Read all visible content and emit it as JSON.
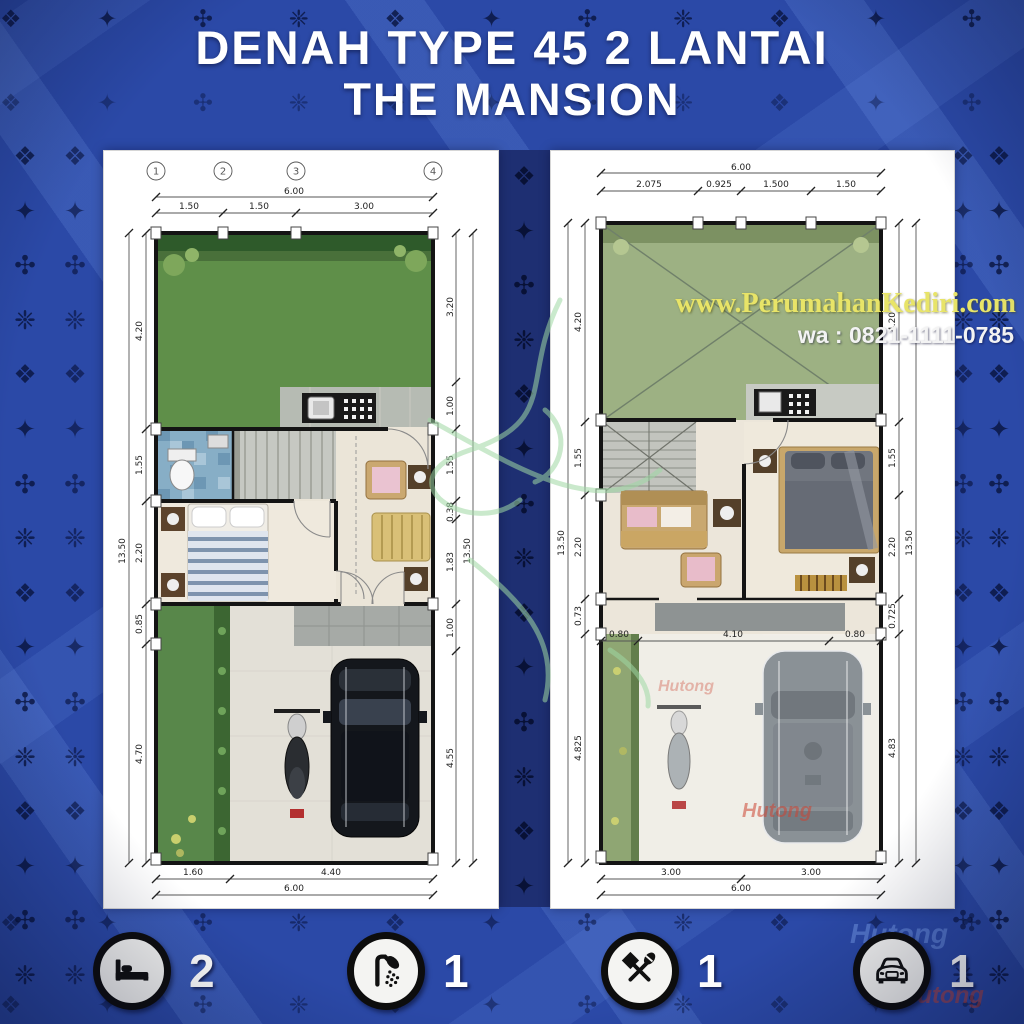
{
  "title": {
    "line1": "DENAH TYPE 45 2 LANTAI",
    "line2": "THE MANSION"
  },
  "watermarks": {
    "website": "www.PerumahanKediri.com",
    "whatsapp": "wa : 0821-1111-0785",
    "brand": "Hutong"
  },
  "ornament": {
    "glyphs": "❖ ✦ ✣ ❈ "
  },
  "plans": [
    {
      "name": "lantai-1",
      "grid_labels": [
        "1",
        "2",
        "3",
        "4"
      ],
      "dims_top": {
        "overall": "6.00",
        "segments": [
          "1.50",
          "1.50",
          "3.00"
        ]
      },
      "dims_left": {
        "overall": "13.50",
        "segments": [
          "4.20",
          "1.55",
          "2.20",
          "0.85",
          "4.70"
        ]
      },
      "dims_right": {
        "overall": "13.50",
        "segments": [
          "3.20",
          "1.00",
          "1.55",
          "0.38",
          "1.83",
          "1.00",
          "4.55"
        ]
      },
      "dims_bottom": {
        "overall": "6.00",
        "segments": [
          "1.60",
          "4.40"
        ]
      }
    },
    {
      "name": "lantai-2",
      "dims_top": {
        "overall": "6.00",
        "segments": [
          "2.075",
          "0.925",
          "1.500",
          "1.50"
        ]
      },
      "dims_left": {
        "overall": "13.50",
        "segments": [
          "4.20",
          "1.55",
          "2.20",
          "0.73",
          "4.825"
        ]
      },
      "dims_right": {
        "overall": "13.50",
        "segments": [
          "4.20",
          "1.55",
          "2.20",
          "0.725",
          "4.83"
        ]
      },
      "dims_inner": [
        "0.80",
        "4.10",
        "0.80"
      ],
      "dims_bottom": {
        "overall": "6.00",
        "segments": [
          "3.00",
          "3.00"
        ]
      }
    }
  ],
  "legend": [
    {
      "icon": "bed-icon",
      "count": "2"
    },
    {
      "icon": "shower-icon",
      "count": "1"
    },
    {
      "icon": "dining-icon",
      "count": "1"
    },
    {
      "icon": "car-icon",
      "count": "1"
    }
  ],
  "colors": {
    "background": "#2b49a7",
    "panel": "#ffffff",
    "garden": "#5f8f49",
    "roof_garden": "#9db183",
    "accent_yellow": "#e8e468",
    "wall": "#141414"
  }
}
